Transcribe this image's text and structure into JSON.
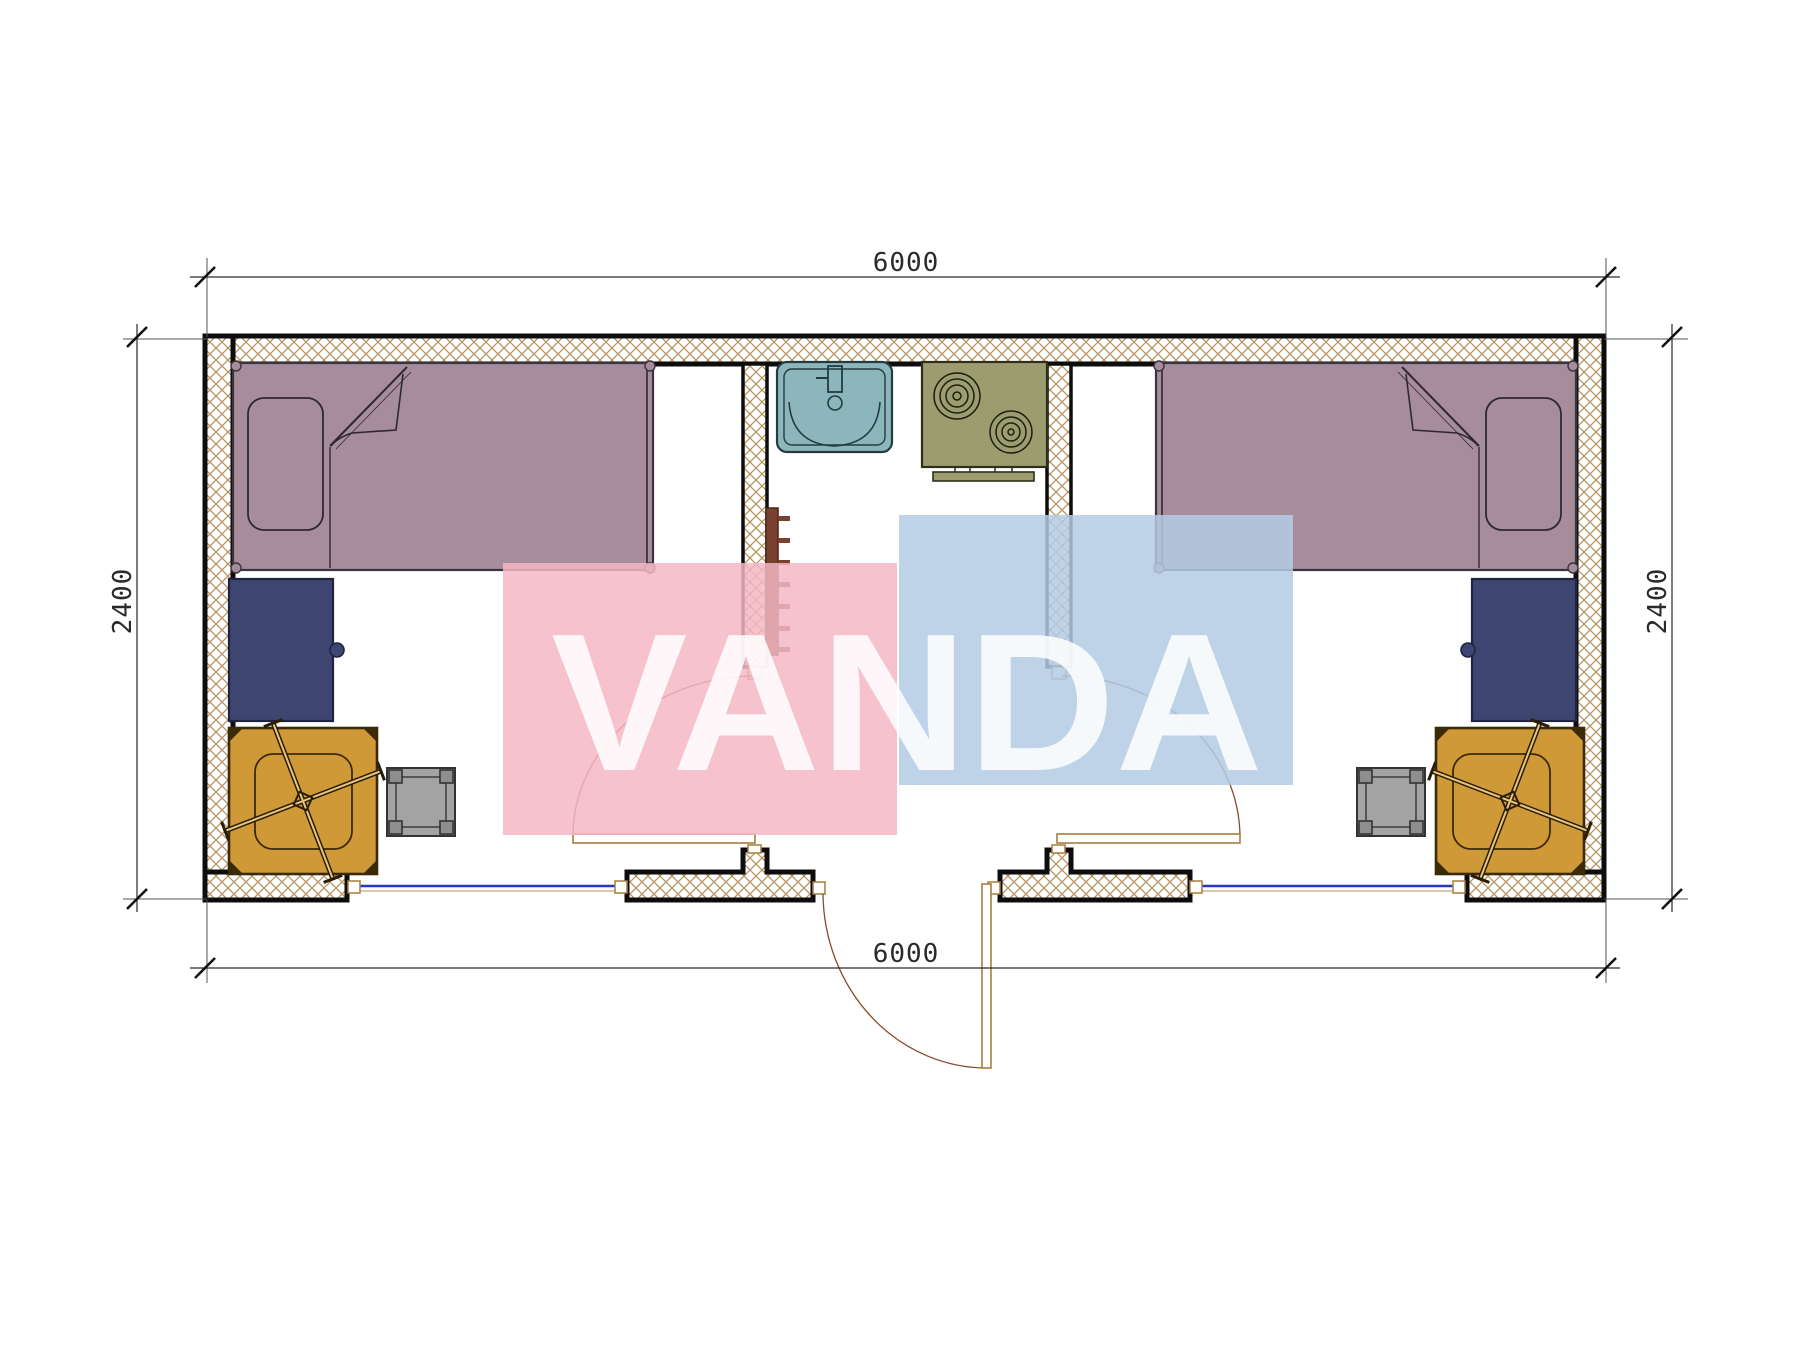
{
  "watermark": {
    "text": "VANDA",
    "pink_color": "#f3b7c4",
    "blue_color": "#b4cbe4",
    "text_color": "rgba(255,255,255,0.85)"
  },
  "dimensions": {
    "top": "6000",
    "bottom": "6000",
    "left": "2400",
    "right": "2400"
  },
  "colors": {
    "bed": "#a78c9b",
    "bed_line": "#3a3340",
    "desk": "#3d4570",
    "chair": "#cf9937",
    "stool": "#a3a3a3",
    "sink": "#8cb6bc",
    "stove": "#9c9d6f",
    "radiator": "#7a4030",
    "window": "#2634c8",
    "wall_hatch": "#b5905a",
    "door": "#a87b3f",
    "dim_line": "#2a2a2a"
  }
}
